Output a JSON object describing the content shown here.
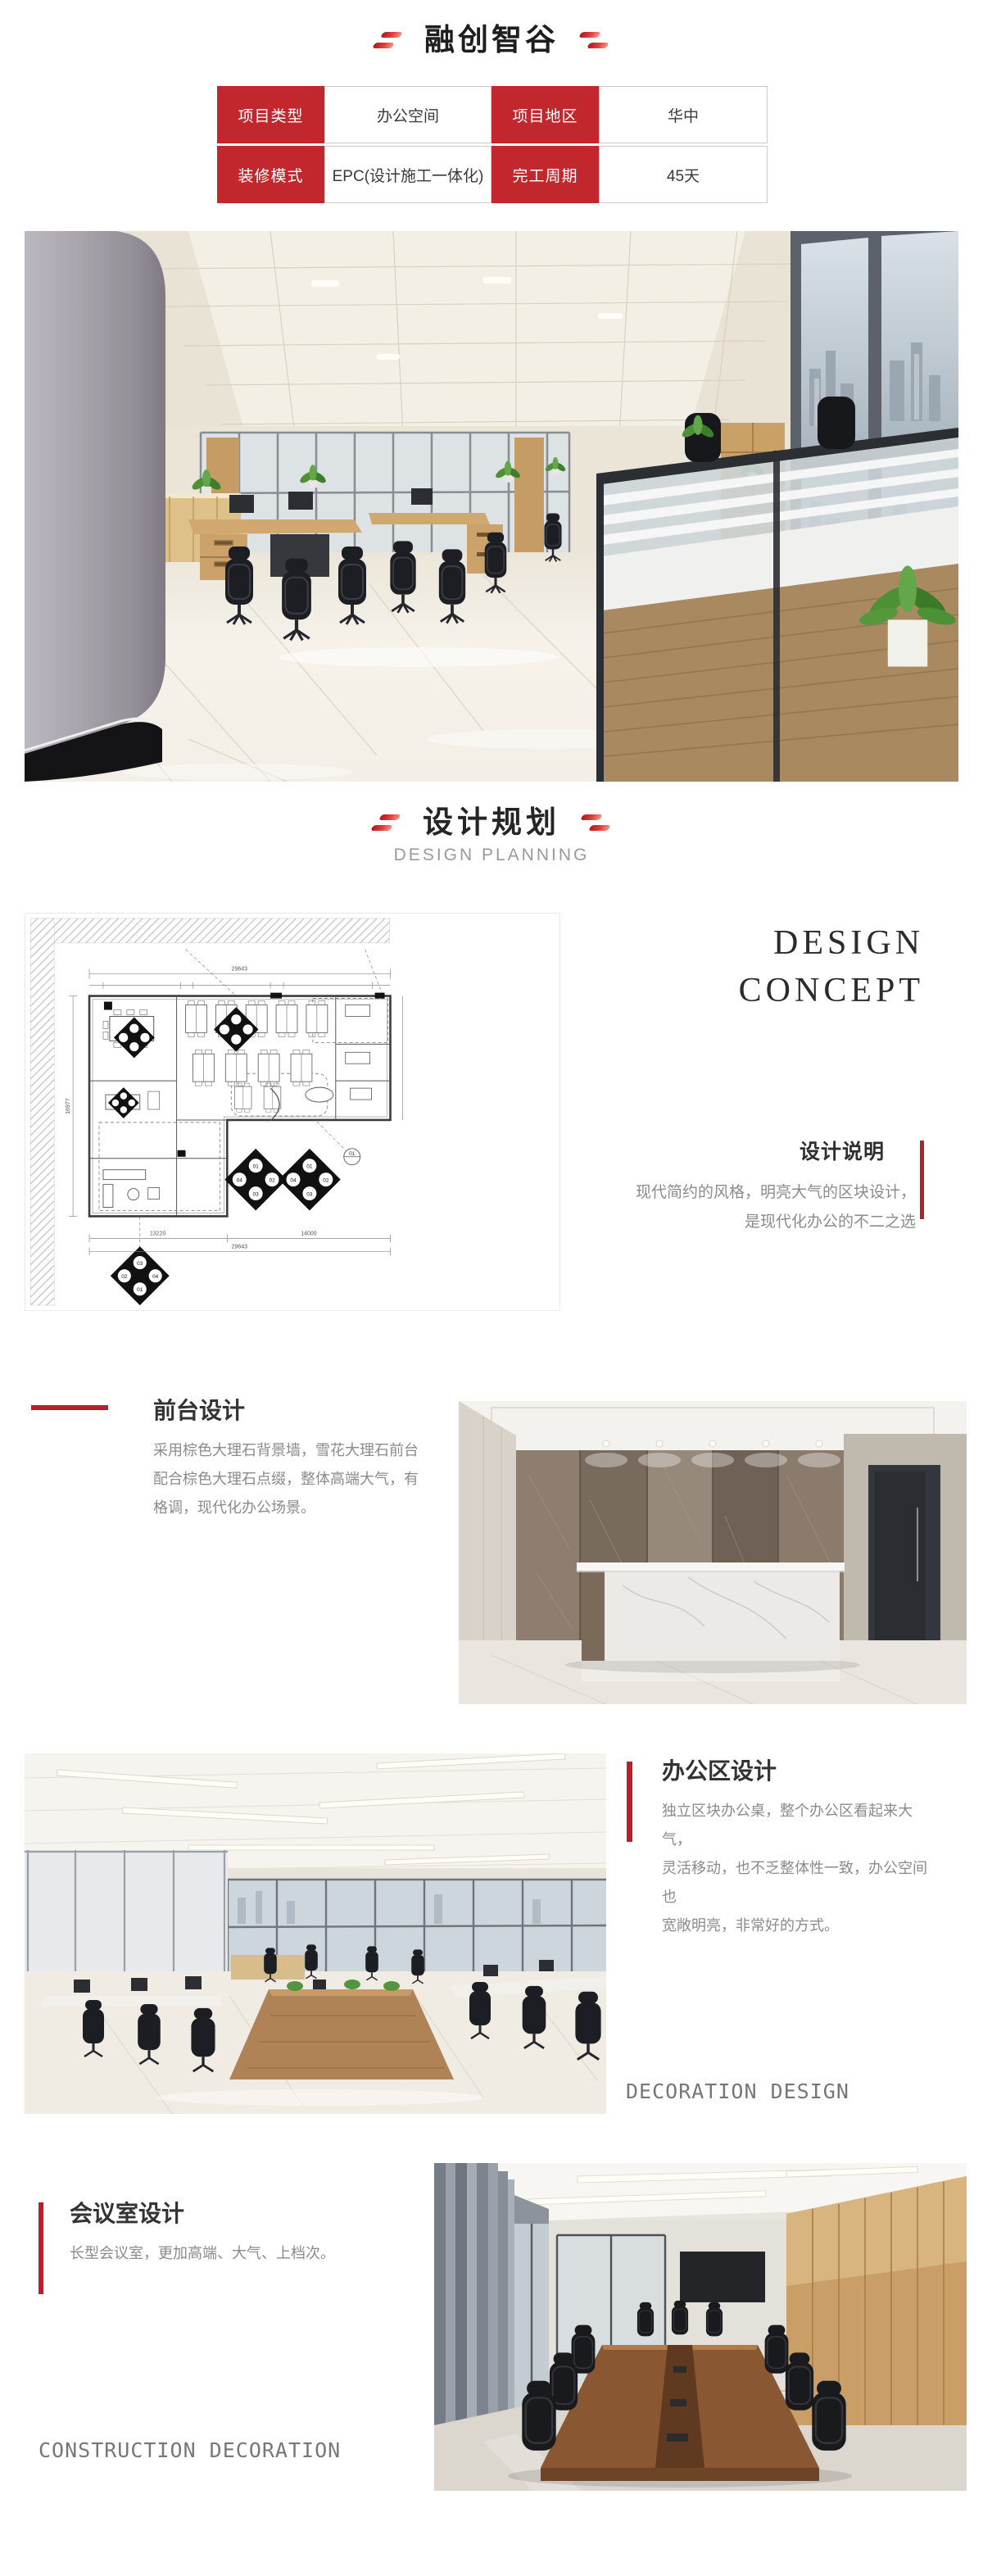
{
  "header": {
    "title": "融创智谷"
  },
  "info_table": {
    "cells": [
      {
        "text": "项目类型"
      },
      {
        "text": "办公空间"
      },
      {
        "text": "项目地区"
      },
      {
        "text": "华中"
      },
      {
        "text": "装修模式"
      },
      {
        "text": "EPC(设计施工一体化)"
      },
      {
        "text": "完工周期"
      },
      {
        "text": "45天"
      }
    ]
  },
  "planning_header": {
    "title": "设计规划",
    "subtitle": "DESIGN PLANNING"
  },
  "design_concept": {
    "line1": "DESIGN",
    "line2": "CONCEPT"
  },
  "design_note": {
    "title": "设计说明",
    "lines": [
      "现代简约的风格，明亮大气的区块设计，",
      "是现代化办公的不二之选"
    ]
  },
  "reception": {
    "title": "前台设计",
    "lines": [
      "采用棕色大理石背景墙，雪花大理石前台",
      "配合棕色大理石点缀，整体高端大气，有",
      "格调，现代化办公场景。"
    ]
  },
  "office_area": {
    "title": "办公区设计",
    "lines": [
      "独立区块办公桌，整个办公区看起来大气，",
      "灵活移动，也不乏整体性一致，办公空间也",
      "宽敞明亮，非常好的方式。"
    ],
    "caption": "DECORATION DESIGN"
  },
  "meeting_room": {
    "title": "会议室设计",
    "lines": [
      "长型会议室，更加高端、大气、上档次。"
    ],
    "caption": "CONSTRUCTION DECORATION"
  },
  "floor_plan": {
    "dim_total_top": "29643",
    "dim_bottom_left": "13220",
    "dim_bottom_right": "14000",
    "dim_total_bottom": "29643",
    "dim_left": "16977",
    "marker_numbers": [
      "01",
      "02",
      "03",
      "04"
    ]
  },
  "colors": {
    "accent_red": "#c1272d",
    "accent_bar": "#b5212a",
    "body_gray": "#8b8b8b"
  }
}
